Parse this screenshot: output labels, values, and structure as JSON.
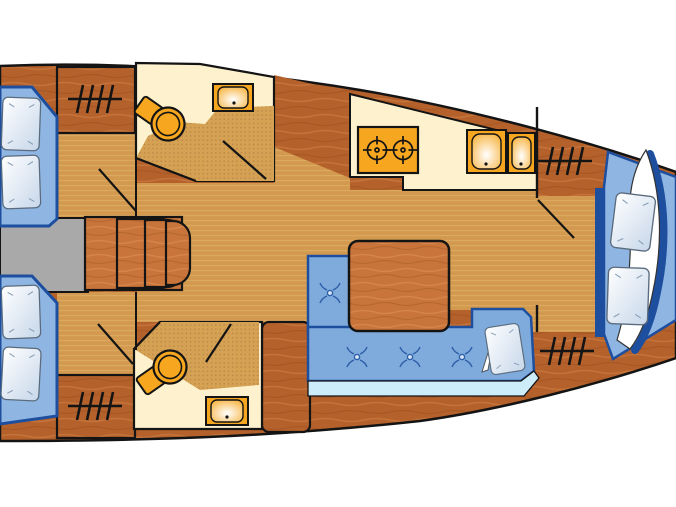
{
  "colors": {
    "hull": "#b5612b",
    "hull_light": "#cf8148",
    "hull_dark": "#9a4f20",
    "furn": "#c8743a",
    "furn_light": "#e09055",
    "floor": "#d39a4f",
    "floor_line": "#deac66",
    "cream": "#fdf2cd",
    "shower": "#d5a153",
    "shower_dot": "#b9834a",
    "orange": "#f6a71f",
    "berth": "#8fb6e3",
    "settee": "#7fabdc",
    "accent": "#1e4f9f",
    "strip": "#cdedfa",
    "tuft": "#2d5ea8",
    "pillow": "#c7d7ea",
    "gray": "#a9a9a9",
    "outline": "#141414",
    "background": "#ffffff"
  },
  "inventory": {
    "type": "yacht-interior-floor-plan",
    "orientation": "bow-right",
    "cabins": [
      {
        "id": "aft-cabin-top",
        "berth": "double",
        "pillows": 2,
        "hanging_locker": true
      },
      {
        "id": "aft-cabin-bottom",
        "berth": "double",
        "pillows": 2,
        "hanging_locker": true
      },
      {
        "id": "fore-cabin",
        "berth": "v-berth",
        "pillows": 2,
        "blanket": true,
        "hanging_lockers": 2
      }
    ],
    "heads": [
      {
        "id": "head-top",
        "toilet": true,
        "sink": true,
        "shower": true
      },
      {
        "id": "head-bottom",
        "toilet": true,
        "sink": true,
        "shower": true
      }
    ],
    "galley": {
      "stove_burners": 2,
      "sinks": 2
    },
    "saloon": {
      "table": true,
      "settee": "L-shaped",
      "cushion_buttons": 4,
      "pillows": 1
    },
    "companionway": {
      "steps": 3
    }
  }
}
